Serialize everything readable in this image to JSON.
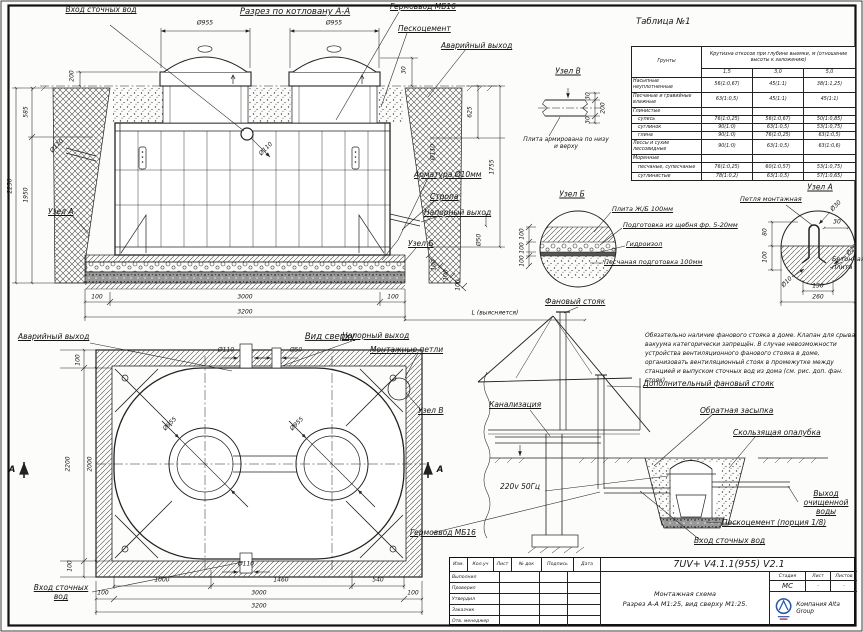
{
  "section": {
    "title": "Разрез по котловану А-А",
    "labels": {
      "inlet": "Вход сточных вод",
      "germovvod": "Гермоввод МБ16",
      "peskocement": "Пескоцемент",
      "emergency": "Аварийный выход",
      "armature": "Арматура Ø10мм",
      "stropa": "Стропа",
      "pressure": "Напорный выход",
      "uzel_a": "Узел А",
      "uzel_b": "Узел Б"
    },
    "dims": {
      "d955a": "Ø955",
      "d955b": "Ø955",
      "d200": "200",
      "d585": "585",
      "d1950": "1950",
      "d2250": "2250",
      "d110l": "Ø110",
      "d110c": "Ø110",
      "d110r": "Ø110",
      "d30": "30",
      "d625": "625",
      "d1755": "1755",
      "d50": "Ø50",
      "d100a": "100",
      "d100b": "100",
      "d100c": "100",
      "d100l": "100",
      "d3000": "3000",
      "d100r": "100",
      "d3200": "3200",
      "dL": "L (выясняется)"
    }
  },
  "table": {
    "caption": "Таблица №1",
    "col_soil": "Грунты",
    "header": "Крутизна откосов при глубине выемки, м (отношение высоты к заложению)",
    "depths": [
      "1,5",
      "3,0",
      "5,0"
    ],
    "rows": [
      {
        "name": "Насыпные неуплотненные",
        "c1": "56(1:0,67)",
        "c2": "45(1:1)",
        "c3": "38(1:1,25)"
      },
      {
        "name": "Песчаные и гравийные влажные",
        "c1": "63(1:0,5)",
        "c2": "45(1:1)",
        "c3": "45(1:1)"
      },
      {
        "name": "Глинистые",
        "c1": "",
        "c2": "",
        "c3": ""
      },
      {
        "name": "супесь",
        "c1": "76(1:0,25)",
        "c2": "56(1:0,67)",
        "c3": "50(1:0,85)"
      },
      {
        "name": "суглинок",
        "c1": "90(1:0)",
        "c2": "63(1:0,5)",
        "c3": "53(1:0,75)"
      },
      {
        "name": "глина",
        "c1": "90(1:0)",
        "c2": "76(1:0,25)",
        "c3": "63(1:0,5)"
      },
      {
        "name": "Лессы и сухие лессовидные",
        "c1": "90(1:0)",
        "c2": "63(1:0,5)",
        "c3": "63(1:0,6)"
      },
      {
        "name": "Моренные",
        "c1": "",
        "c2": "",
        "c3": ""
      },
      {
        "name": "песчаные, супесчаные",
        "c1": "76(1:0,25)",
        "c2": "60(1:0,57)",
        "c3": "53(1:0,75)"
      },
      {
        "name": "суглинистые",
        "c1": "78(1:0,2)",
        "c2": "63(1:0,5)",
        "c3": "57(1:0,65)"
      }
    ]
  },
  "uzel_v": {
    "title": "Узел В",
    "note": "Плита армирована по низу и верху",
    "d30t": "30",
    "d200": "200",
    "d30b": "30"
  },
  "uzel_b": {
    "title": "Узел Б",
    "l1": "Плита Ж/Б 100мм",
    "l2": "Подготовка из щебня фр. 5-20мм",
    "l3": "Гидроизол",
    "l4": "Песчаная подготовка 100мм",
    "d1": "100",
    "d2": "100",
    "d3": "100"
  },
  "uzel_a": {
    "title": "Узел А",
    "loop": "Петля монтажная",
    "concrete": "Бетонная плита",
    "d30d": "Ø30",
    "d30": "30",
    "d80": "80",
    "d100": "100",
    "d20": "Ø20",
    "d10": "Ø10",
    "d130": "130",
    "d260": "260"
  },
  "plan": {
    "title": "Вид сверху",
    "labels": {
      "emergency": "Аварийный выход",
      "pressure": "Напорный выход",
      "loops": "Монтажные петли",
      "uzel_v": "Узел В",
      "germovvod": "Гермоввод МБ16",
      "inlet": "Вход сточных вод"
    },
    "marker_a": "А",
    "dims": {
      "d110t": "Ø110",
      "d50t": "Ø50",
      "d100t": "100",
      "d2200": "2200",
      "d2000": "2000",
      "d955a": "Ø955",
      "d955b": "Ø955",
      "d100b": "100",
      "d110b": "Ø110",
      "d1000": "1000",
      "d1460": "1460",
      "d540": "540",
      "d100l": "100",
      "d3000": "3000",
      "d100r": "100",
      "d3200": "3200"
    }
  },
  "house": {
    "labels": {
      "vent": "Фановый стояк",
      "sewer": "Канализация",
      "power": "220v 50Гц",
      "add_vent": "Дополнительный фановый стояк",
      "backfill": "Обратная засыпка",
      "formwork": "Скользящая опалубка",
      "outlet": "Выход очищенной воды",
      "peskocement": "Пескоцемент (порция 1/8)",
      "inlet": "Вход сточных вод"
    }
  },
  "notes": {
    "text": "Обязательно наличие фанового стояка в доме. Клапан для срыва вакуума категорически запрещён. В случае невозможности устройства вентиляционного фанового стояка в доме, организовать вентиляционный стояк в промежутке между станцией и выпуском сточных вод из дома (см. рис. доп. фан. стояк)."
  },
  "titleblock": {
    "doc_code": "7UV+ V4.1.1(955) V2.1",
    "cols": [
      "Изм.",
      "Кол.уч",
      "Лист",
      "№ док",
      "Подпись",
      "Дата"
    ],
    "rows": [
      "Выполнил",
      "Проверил",
      "Утвердил",
      "Заказчик",
      "Отв. менеджер"
    ],
    "scheme_line1": "Монтажная схема",
    "scheme_line2": "Разрез А-А М1:25, вид сверху М1:25.",
    "stage_cols": [
      "Стадия",
      "Лист",
      "Листов"
    ],
    "stage_vals": [
      "МС",
      "–",
      "–"
    ],
    "company": "Компания Alta Group"
  }
}
